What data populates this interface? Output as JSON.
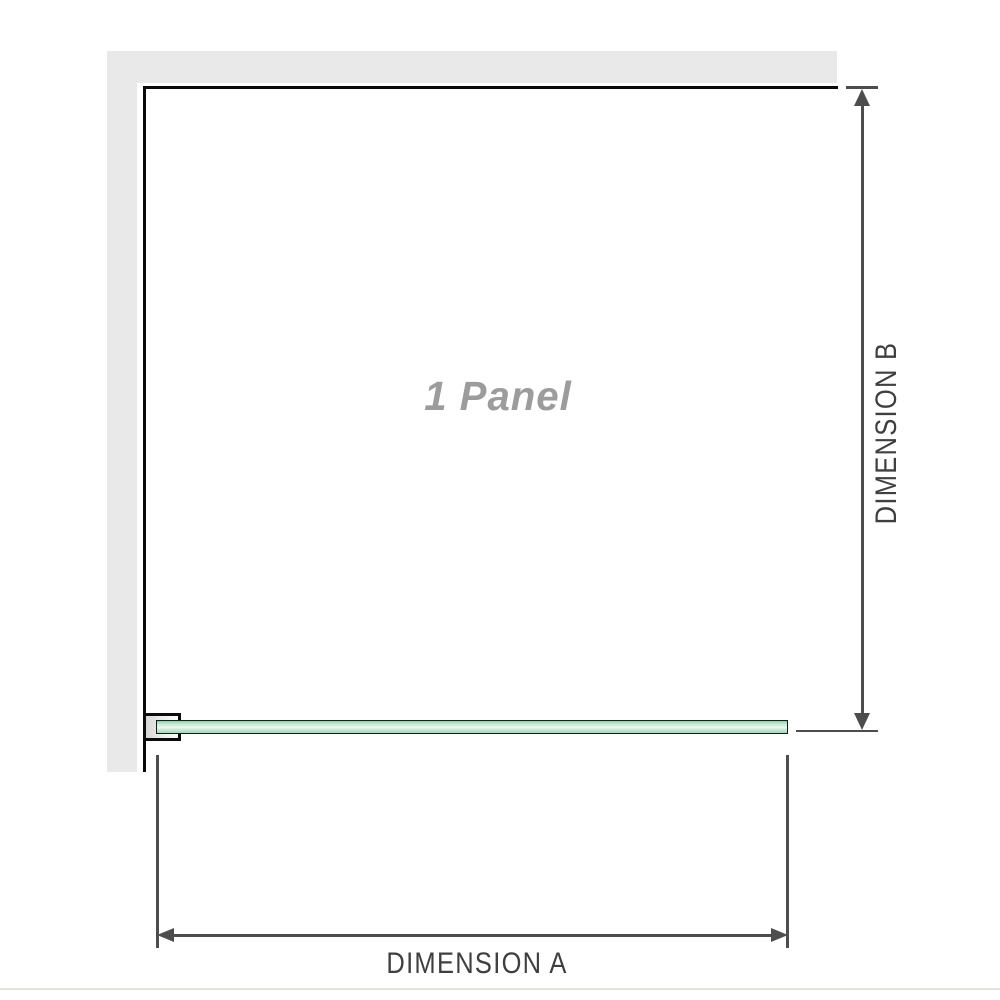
{
  "diagram": {
    "title": "shower-screen-panel-dimension-diagram",
    "panel_label": "1 Panel",
    "dimension_a": {
      "label": "DIMENSION A",
      "orientation": "horizontal"
    },
    "dimension_b": {
      "label": "DIMENSION B",
      "orientation": "vertical"
    },
    "colors": {
      "wall_fill": "#e9e9e9",
      "wall_edge": "#0a0a0a",
      "dimension_lines": "#4d4d4d",
      "dimension_text": "#3f3f3f",
      "panel_label_gray": "#9c9c9c",
      "glass_fill": "#b0ddc3",
      "glass_highlight": "#edf8f1",
      "glass_border": "#10211a",
      "bracket_fill": "#e0e0e0"
    }
  }
}
